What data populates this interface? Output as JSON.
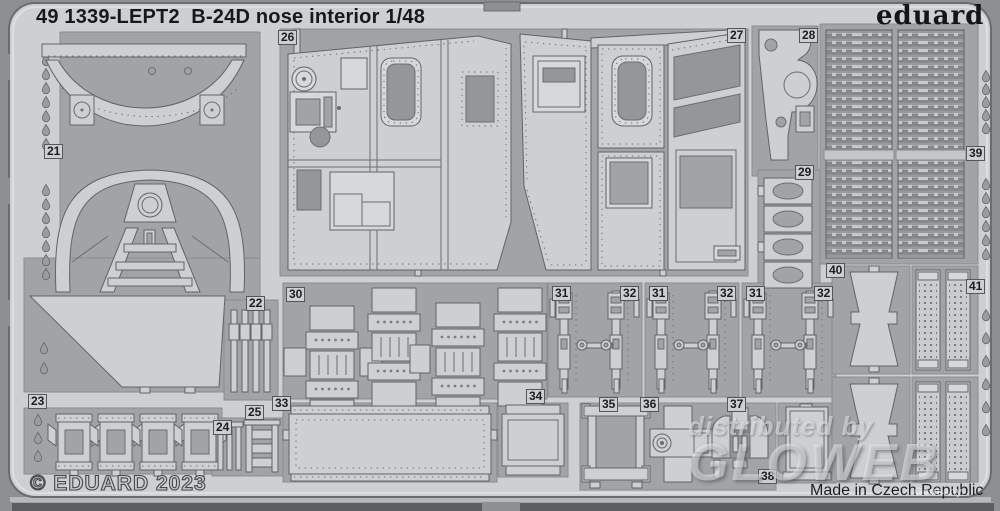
{
  "header": {
    "title": "49 1339-LEPT2  B-24D nose interior 1/48",
    "brand": "eduard"
  },
  "footer": {
    "copyright": "© EDUARD 2023",
    "made_in": "Made in Czech Republic"
  },
  "watermark": {
    "line1": "distributed by",
    "line2": "GLOWEB",
    "line3": "Germany"
  },
  "colors": {
    "metal": "#cdcfd1",
    "etched_background": "#a1a3a5",
    "photo_background": "#8e8f90",
    "text": "#1b1d1f"
  },
  "part_numbers": [
    "21",
    "22",
    "23",
    "24",
    "25",
    "26",
    "27",
    "28",
    "29",
    "30",
    "31",
    "32",
    "33",
    "34",
    "35",
    "36",
    "37",
    "38",
    "39",
    "40",
    "41"
  ],
  "labels": [
    {
      "text": "21"
    },
    {
      "text": "22"
    },
    {
      "text": "23"
    },
    {
      "text": "24"
    },
    {
      "text": "25"
    },
    {
      "text": "26"
    },
    {
      "text": "27"
    },
    {
      "text": "28"
    },
    {
      "text": "29"
    },
    {
      "text": "30"
    },
    {
      "text": "31"
    },
    {
      "text": "32"
    },
    {
      "text": "31"
    },
    {
      "text": "32"
    },
    {
      "text": "31"
    },
    {
      "text": "32"
    },
    {
      "text": "33"
    },
    {
      "text": "34"
    },
    {
      "text": "35"
    },
    {
      "text": "36"
    },
    {
      "text": "37"
    },
    {
      "text": "38"
    },
    {
      "text": "39"
    },
    {
      "text": "40"
    },
    {
      "text": "41"
    }
  ]
}
